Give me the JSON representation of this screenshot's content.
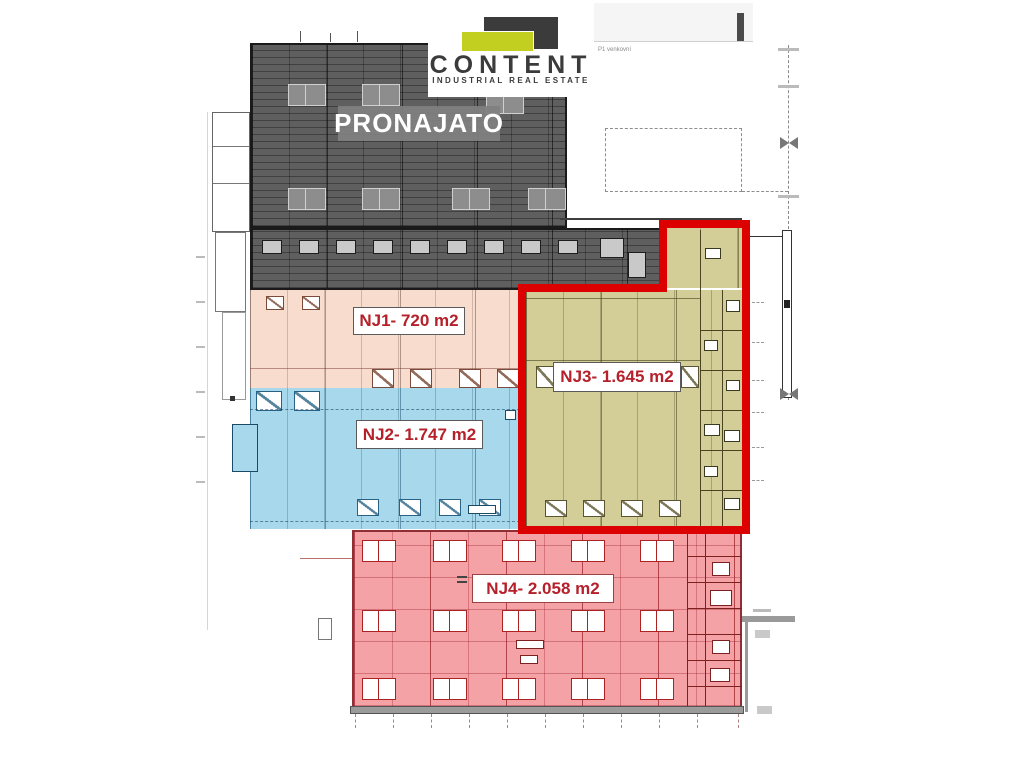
{
  "brand": {
    "name": "CONTENT",
    "tagline": "INDUSTRIAL REAL ESTATE",
    "mark_dark_color": "#3b3b3b",
    "mark_lime_color": "#c3cf20"
  },
  "plan": {
    "top_note": "P1 venkovní",
    "highlight_color": "#dd0000",
    "label_text_color": "#b5202a",
    "zones": [
      {
        "id": "pronajato",
        "label": "PRONAJATO",
        "color": "#5f5f5f"
      },
      {
        "id": "nj1",
        "label": "NJ1- 720 m2",
        "color": "#f8dcce"
      },
      {
        "id": "nj2",
        "label": "NJ2- 1.747 m2",
        "color": "#a7d8ec"
      },
      {
        "id": "nj3",
        "label": "NJ3- 1.645 m2",
        "color": "#d3cd98"
      },
      {
        "id": "nj4",
        "label": "NJ4- 2.058 m2",
        "color": "#f4a2a6"
      }
    ]
  }
}
